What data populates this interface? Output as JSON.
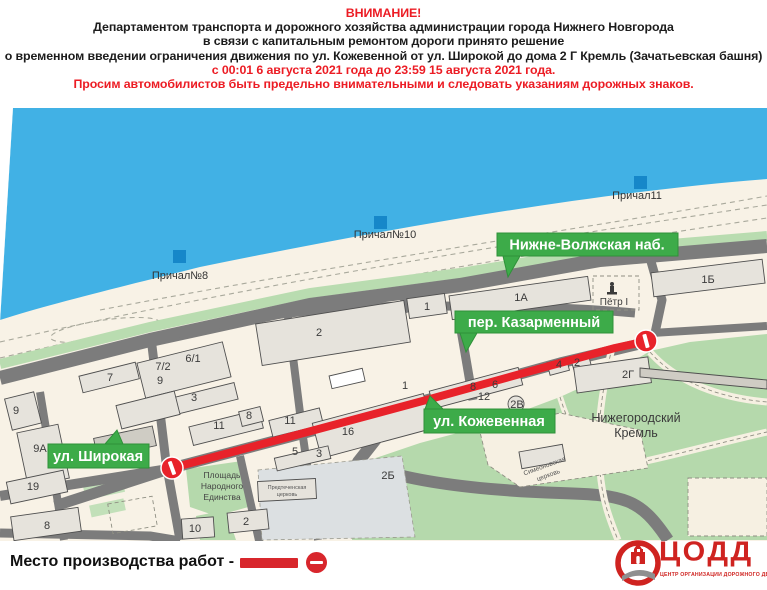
{
  "header": {
    "line1": "ВНИМАНИЕ!",
    "line2": "Департаментом транспорта и дорожного хозяйства администрации города Нижнего Новгорода",
    "line3": "в связи с капитальным ремонтом дороги принято решение",
    "line4": "о временном введении ограничения движения по ул. Кожевенной от ул. Широкой до дома 2 Г Кремль (Зачатьевская башня)",
    "line5": "с 00:01 6 августа 2021 года до 23:59 15 августа 2021 года.",
    "line6": "Просим автомобилистов быть предельно внимательными и следовать указаниям дорожных знаков."
  },
  "map": {
    "piers": {
      "p8": "Причал№8",
      "p10": "Причал№10",
      "p11": "Причал11"
    },
    "street_labels": {
      "embankment": "Нижне-Волжская наб.",
      "kazarmenny": "пер. Казарменный",
      "kozhevennaya": "ул. Кожевенная",
      "shirokaya": "ул. Широкая"
    },
    "buildings": {
      "b1a": "1А",
      "b1b": "1Б",
      "b1top": "1",
      "b2top": "2",
      "b7": "7",
      "b72": "7/2",
      "b9mid": "9",
      "b61": "6/1",
      "b3": "3",
      "b11a": "11",
      "b8a": "8",
      "b11b": "11",
      "b16": "16",
      "b5": "5",
      "b3b": "3",
      "b1k": "1",
      "b12": "12",
      "b8b": "8",
      "b6": "6",
      "b4": "4",
      "b2s": "2",
      "b2g": "2Г",
      "b2v": "2В",
      "b2be": "2Б",
      "b9l": "9",
      "b9a": "9А",
      "b19": "19",
      "b8l": "8",
      "b10": "10",
      "b2c": "2"
    },
    "poi": {
      "petr": "Пётр I",
      "kremlin1": "Нижегородский",
      "kremlin2": "Кремль",
      "square1": "Площадь",
      "square2": "Народного",
      "square3": "Единства",
      "church1a": "Предтеченская",
      "church1b": "церковь",
      "church2a": "Симеоновская",
      "church2b": "церковь"
    },
    "colors": {
      "water": "#41b1e5",
      "land": "#f8f2e6",
      "road": "#7c7c7c",
      "green": "#b5d9ac",
      "building": "#e6e3dc",
      "closure_red": "#e8222a",
      "label_green": "#3dab49",
      "pier_blue": "#1687c9"
    }
  },
  "legend": {
    "label": "Место производства работ -"
  },
  "logo": {
    "name": "ЦОДД",
    "subtitle": "ЦЕНТР ОРГАНИЗАЦИИ ДОРОЖНОГО ДВИЖЕНИЯ"
  }
}
